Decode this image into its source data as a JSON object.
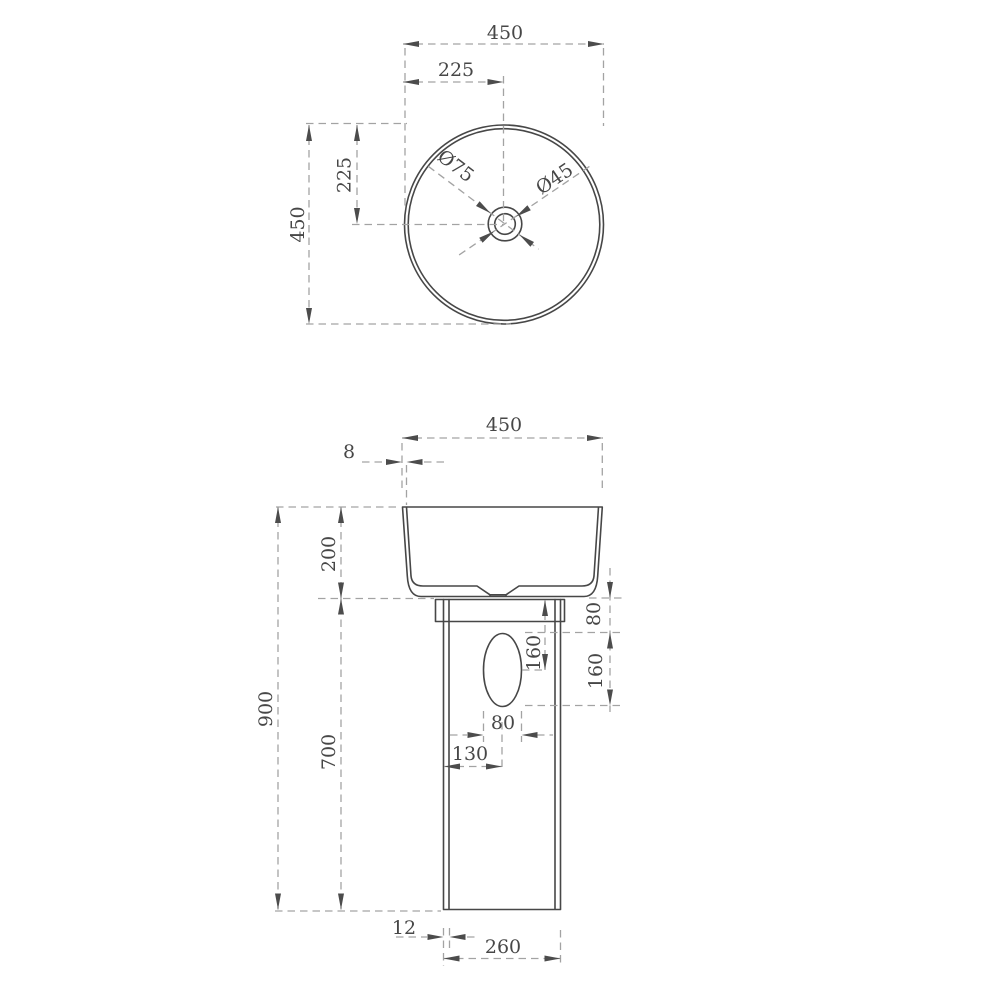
{
  "drawing": {
    "type": "technical-dimension-drawing",
    "subject": "round pedestal wash basin, plan view and front elevation",
    "colors": {
      "background": "#ffffff",
      "object_line": "#474747",
      "dimension_line": "#a3a3a3",
      "arrowhead": "#4c4c4c",
      "text": "#474747"
    },
    "top_view": {
      "width_label": "450",
      "half_width_label": "225",
      "height_label": "450",
      "half_height_label": "225",
      "drain_outer_label": "Ø75",
      "drain_inner_label": "Ø45"
    },
    "front_view": {
      "width_label": "450",
      "rim_thickness_label": "8",
      "basin_height_label": "200",
      "overall_height_label": "900",
      "pedestal_height_label": "700",
      "slot_offset_label": "80",
      "slot_height_label": "160",
      "slot_center_offset_label": "160",
      "slot_width_label": "80",
      "slot_center_x_label": "130",
      "pedestal_wall_label": "12",
      "pedestal_base_width_label": "260"
    }
  }
}
